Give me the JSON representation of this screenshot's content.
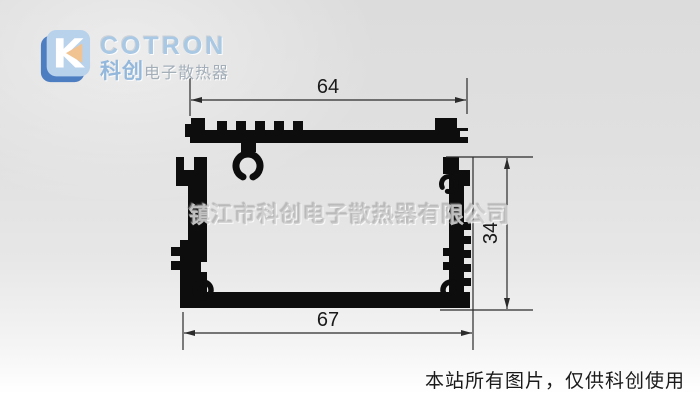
{
  "logo": {
    "brand": "COTRON",
    "brand_cn_bold": "科创",
    "brand_cn_rest": "电子散热器",
    "icon_letter": "K",
    "colors": {
      "light_blue": "#b8d2ec",
      "blue": "#4e7ec2",
      "orange": "#f1c390",
      "brand_text": "#a9c8e4"
    }
  },
  "drawing": {
    "type": "aluminum-profile-cross-section",
    "dim_top": "64",
    "dim_bottom": "67",
    "dim_side": "34",
    "line_color": "#0d0d0d",
    "dimension_line_color": "#2b2b2b"
  },
  "watermark_text": "镇江市科创电子散热器有限公司",
  "footer_note": "本站所有图片，仅供科创使用"
}
